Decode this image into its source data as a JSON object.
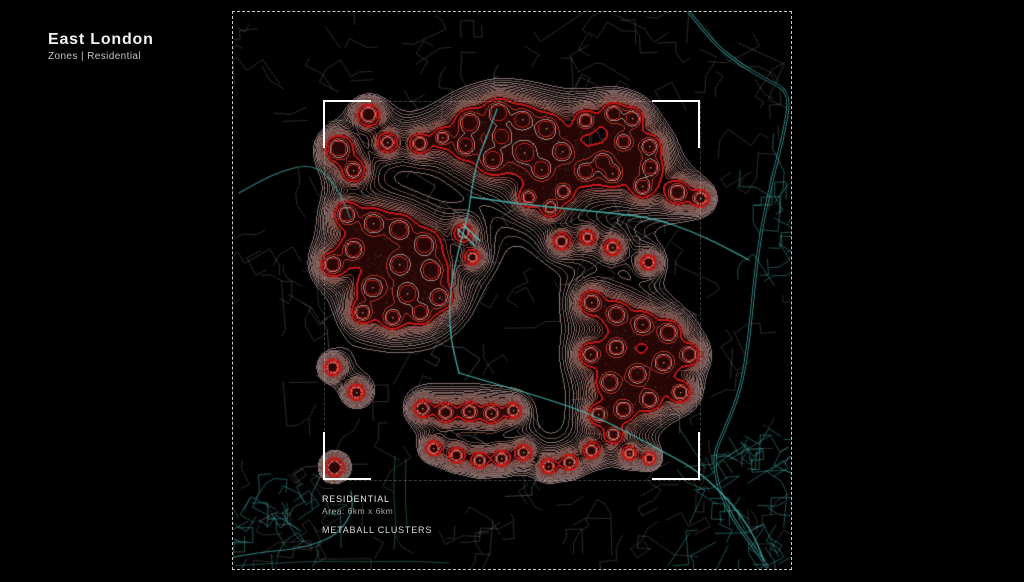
{
  "header": {
    "title": "East London",
    "subtitle": "Zones | Residential"
  },
  "map": {
    "frame": {
      "x": 232,
      "y": 11,
      "w": 558,
      "h": 557
    },
    "inner_square": {
      "x": 323,
      "y": 100,
      "w": 375,
      "h": 378,
      "bracket_len": 46
    },
    "labels": {
      "zone": "RESIDENTIAL",
      "area": "Area: 6km x 6km",
      "caption": "METABALL CLUSTERS"
    },
    "colors": {
      "background": "#000000",
      "street": "rgba(255,255,255,0.17)",
      "street_inside": "rgba(255,255,255,0.24)",
      "teal_street": "rgba(62,165,160,0.5)",
      "dot": "rgba(235,230,230,0.55)",
      "amber_dot": "rgba(205,175,95,0.9)",
      "core_fill": [
        47,
        9,
        7,
        205
      ],
      "wash_fill": [
        70,
        16,
        12,
        38
      ],
      "river_double": "rgba(64,170,165,0.95)",
      "river_canal": "rgba(72,186,180,0.9)",
      "river_minor": "rgba(60,162,156,0.8)",
      "river_faint": "rgba(48,128,124,0.55)",
      "river_lock": "rgba(90,200,195,0.95)"
    },
    "contour_levels": [
      [
        0.46,
        205,
        175,
        175,
        165,
        1
      ],
      [
        0.49,
        175,
        130,
        128,
        160,
        1
      ],
      [
        0.52,
        210,
        182,
        182,
        165,
        1
      ],
      [
        0.55,
        170,
        120,
        116,
        165,
        1
      ],
      [
        0.58,
        205,
        172,
        170,
        165,
        1
      ],
      [
        0.61,
        165,
        112,
        106,
        170,
        1
      ],
      [
        0.645,
        200,
        162,
        158,
        165,
        1
      ],
      [
        0.68,
        160,
        102,
        95,
        175,
        1
      ],
      [
        0.715,
        198,
        155,
        150,
        170,
        1
      ],
      [
        0.75,
        158,
        95,
        88,
        180,
        1
      ],
      [
        0.785,
        195,
        148,
        142,
        170,
        1
      ],
      [
        0.82,
        155,
        88,
        80,
        185,
        1
      ],
      [
        0.86,
        190,
        138,
        130,
        175,
        1
      ],
      [
        0.9,
        150,
        80,
        72,
        190,
        1
      ],
      [
        0.945,
        188,
        130,
        122,
        180,
        1
      ],
      [
        1.0,
        180,
        75,
        65,
        190,
        1
      ],
      [
        1.12,
        196,
        22,
        22,
        255,
        2
      ],
      [
        1.6,
        205,
        55,
        45,
        225,
        1
      ],
      [
        2.1,
        215,
        165,
        158,
        205,
        1
      ],
      [
        2.7,
        205,
        32,
        28,
        240,
        1
      ]
    ],
    "wash_threshold": 0.86,
    "core_threshold": 1.12,
    "metaballs": [
      [
        367,
        113,
        10
      ],
      [
        337,
        147,
        12
      ],
      [
        352,
        169,
        9
      ],
      [
        386,
        141,
        8
      ],
      [
        418,
        142,
        8
      ],
      [
        441,
        136,
        7
      ],
      [
        468,
        121,
        11
      ],
      [
        497,
        111,
        11
      ],
      [
        521,
        118,
        10
      ],
      [
        545,
        127,
        11
      ],
      [
        561,
        150,
        10
      ],
      [
        523,
        151,
        12
      ],
      [
        491,
        158,
        11
      ],
      [
        464,
        144,
        10
      ],
      [
        540,
        168,
        10
      ],
      [
        500,
        135,
        9
      ],
      [
        584,
        119,
        8
      ],
      [
        612,
        112,
        9
      ],
      [
        631,
        117,
        9
      ],
      [
        648,
        145,
        9
      ],
      [
        622,
        140,
        8
      ],
      [
        601,
        160,
        9
      ],
      [
        649,
        166,
        9
      ],
      [
        584,
        170,
        9
      ],
      [
        611,
        172,
        9
      ],
      [
        641,
        185,
        9
      ],
      [
        676,
        191,
        10
      ],
      [
        699,
        197,
        8
      ],
      [
        527,
        196,
        7
      ],
      [
        549,
        206,
        7
      ],
      [
        560,
        240,
        7
      ],
      [
        586,
        236,
        6
      ],
      [
        611,
        246,
        7
      ],
      [
        647,
        261,
        7
      ],
      [
        562,
        190,
        7
      ],
      [
        345,
        213,
        10
      ],
      [
        372,
        222,
        11
      ],
      [
        398,
        228,
        11
      ],
      [
        423,
        243,
        11
      ],
      [
        352,
        248,
        10
      ],
      [
        331,
        263,
        10
      ],
      [
        398,
        263,
        11
      ],
      [
        430,
        269,
        11
      ],
      [
        371,
        286,
        11
      ],
      [
        406,
        292,
        11
      ],
      [
        438,
        296,
        10
      ],
      [
        361,
        311,
        9
      ],
      [
        391,
        316,
        9
      ],
      [
        419,
        311,
        9
      ],
      [
        331,
        366,
        8
      ],
      [
        355,
        391,
        8
      ],
      [
        462,
        231,
        7
      ],
      [
        471,
        256,
        6
      ],
      [
        590,
        301,
        10
      ],
      [
        615,
        313,
        10
      ],
      [
        641,
        323,
        10
      ],
      [
        667,
        331,
        10
      ],
      [
        688,
        353,
        9
      ],
      [
        662,
        361,
        10
      ],
      [
        636,
        373,
        10
      ],
      [
        608,
        381,
        10
      ],
      [
        589,
        353,
        9
      ],
      [
        615,
        346,
        9
      ],
      [
        648,
        398,
        9
      ],
      [
        622,
        408,
        9
      ],
      [
        597,
        413,
        8
      ],
      [
        679,
        391,
        9
      ],
      [
        421,
        407,
        8
      ],
      [
        444,
        411,
        8
      ],
      [
        468,
        410,
        8
      ],
      [
        490,
        412,
        8
      ],
      [
        512,
        409,
        7
      ],
      [
        432,
        447,
        7
      ],
      [
        455,
        454,
        7
      ],
      [
        478,
        459,
        7
      ],
      [
        500,
        457,
        7
      ],
      [
        522,
        451,
        7
      ],
      [
        547,
        465,
        7
      ],
      [
        568,
        461,
        7
      ],
      [
        590,
        449,
        7
      ],
      [
        612,
        433,
        7
      ],
      [
        628,
        452,
        6
      ],
      [
        648,
        457,
        6
      ],
      [
        333,
        466,
        10
      ]
    ],
    "streets": {
      "seed": 11,
      "count": 220,
      "min_seg": 7,
      "max_seg": 20
    },
    "dots": {
      "count": 2600,
      "min_v": 0.46
    },
    "teal_patches": [
      {
        "x": 688,
        "y": 432,
        "w": 100,
        "h": 132,
        "count": 46
      },
      {
        "x": 233,
        "y": 497,
        "w": 95,
        "h": 66,
        "count": 26
      },
      {
        "x": 737,
        "y": 182,
        "w": 52,
        "h": 115,
        "count": 16
      }
    ],
    "rivers": [
      {
        "style": "double",
        "pts": [
          [
            688,
            11
          ],
          [
            700,
            26
          ],
          [
            716,
            45
          ],
          [
            740,
            64
          ],
          [
            766,
            79
          ],
          [
            789,
            91
          ],
          [
            784,
            128
          ],
          [
            772,
            175
          ],
          [
            760,
            228
          ],
          [
            753,
            285
          ],
          [
            748,
            338
          ],
          [
            740,
            388
          ],
          [
            724,
            428
          ],
          [
            712,
            455
          ],
          [
            718,
            490
          ],
          [
            733,
            520
          ],
          [
            752,
            545
          ],
          [
            766,
            566
          ]
        ]
      },
      {
        "style": "canal",
        "pts": [
          [
            496,
            108
          ],
          [
            487,
            133
          ],
          [
            476,
            160
          ],
          [
            470,
            192
          ],
          [
            468,
            210
          ],
          [
            460,
            240
          ],
          [
            452,
            272
          ],
          [
            448,
            305
          ],
          [
            450,
            340
          ],
          [
            458,
            372
          ]
        ]
      },
      {
        "style": "canal",
        "pts": [
          [
            470,
            196
          ],
          [
            512,
            202
          ],
          [
            558,
            207
          ],
          [
            610,
            212
          ],
          [
            652,
            217
          ],
          [
            690,
            230
          ],
          [
            722,
            245
          ],
          [
            748,
            259
          ]
        ]
      },
      {
        "style": "canal",
        "pts": [
          [
            458,
            372
          ],
          [
            502,
            385
          ],
          [
            546,
            398
          ],
          [
            587,
            412
          ],
          [
            624,
            430
          ],
          [
            661,
            450
          ],
          [
            694,
            468
          ],
          [
            720,
            491
          ],
          [
            740,
            514
          ],
          [
            755,
            539
          ],
          [
            763,
            560
          ]
        ]
      },
      {
        "style": "minor",
        "pts": [
          [
            233,
            556
          ],
          [
            260,
            551
          ],
          [
            288,
            549
          ],
          [
            314,
            543
          ],
          [
            333,
            535
          ],
          [
            346,
            521
          ],
          [
            352,
            506
          ],
          [
            350,
            490
          ]
        ]
      },
      {
        "style": "faint",
        "pts": [
          [
            233,
            565
          ],
          [
            275,
            562
          ],
          [
            320,
            560
          ],
          [
            365,
            561
          ],
          [
            410,
            560
          ],
          [
            448,
            562
          ]
        ]
      },
      {
        "style": "minor",
        "pts": [
          [
            238,
            192
          ],
          [
            259,
            180
          ],
          [
            281,
            170
          ],
          [
            305,
            164
          ],
          [
            322,
            170
          ],
          [
            335,
            186
          ],
          [
            344,
            203
          ],
          [
            349,
            217
          ]
        ]
      },
      {
        "style": "faint",
        "pts": [
          [
            394,
            455
          ],
          [
            392,
            490
          ],
          [
            395,
            520
          ],
          [
            393,
            548
          ]
        ]
      },
      {
        "style": "faint",
        "pts": [
          [
            405,
            458
          ],
          [
            404,
            494
          ],
          [
            406,
            524
          ]
        ]
      },
      {
        "style": "lock",
        "pts": [
          [
            462,
            223
          ],
          [
            479,
            240
          ]
        ]
      },
      {
        "style": "lock",
        "pts": [
          [
            457,
            228
          ],
          [
            474,
            245
          ]
        ]
      }
    ]
  }
}
